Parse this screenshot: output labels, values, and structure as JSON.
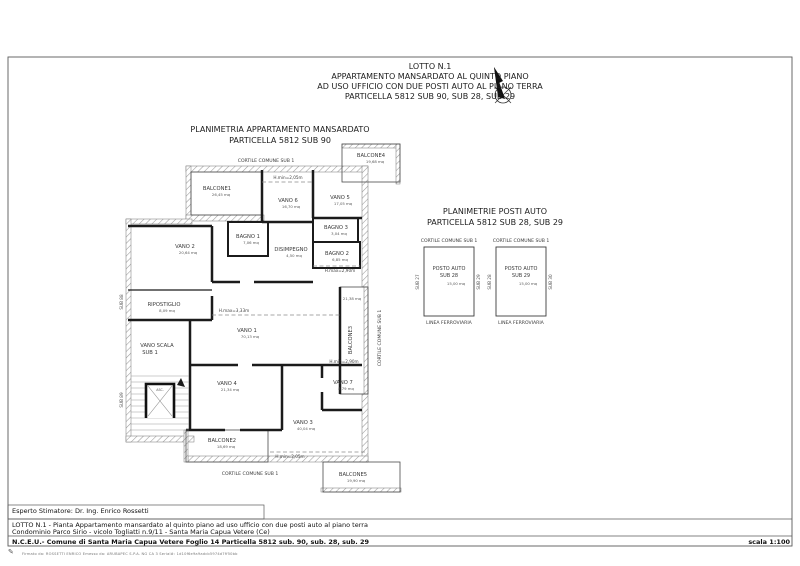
{
  "header": {
    "line1": "LOTTO N.1",
    "line2": "APPARTAMENTO MANSARDATO AL QUINTO PIANO",
    "line3": "AD USO UFFICIO CON DUE POSTI AUTO AL PIANO TERRA",
    "line4": "PARTICELLA 5812 SUB 90, SUB 28, SUB 29"
  },
  "plan_title": {
    "line1": "PLANIMETRIA APPARTAMENTO MANSARDATO",
    "line2": "PARTICELLA 5812 SUB 90"
  },
  "parking_title": {
    "line1": "PLANIMETRIE POSTI AUTO",
    "line2": "PARTICELLA 5812 SUB 28, SUB 29"
  },
  "plan": {
    "cortile_top": "CORTILE COMUNE SUB 1",
    "cortile_bottom": "CORTILE COMUNE SUB 1",
    "cortile_right": "CORTILE COMUNE SUB 1",
    "sub88": "SUB 88",
    "sub89": "SUB 89",
    "stair_label1": "VANO SCALA",
    "stair_label2": "SUB 1",
    "elevator": "ASC.",
    "rooms": {
      "vano1": {
        "name": "VANO 1",
        "area": "70,13 mq"
      },
      "vano2": {
        "name": "VANO 2",
        "area": "20,64 mq"
      },
      "vano3": {
        "name": "VANO 3",
        "area": "40,04 mq"
      },
      "vano4": {
        "name": "VANO 4",
        "area": "21,34 mq"
      },
      "vano5": {
        "name": "VANO 5",
        "area": "17,05 mq"
      },
      "vano6": {
        "name": "VANO 6",
        "area": "16,70 mq"
      },
      "vano7": {
        "name": "VANO 7",
        "area": "8,79 mq"
      },
      "bagno1": {
        "name": "BAGNO 1",
        "area": "7,06 mq"
      },
      "bagno2": {
        "name": "BAGNO 2",
        "area": "6,85 mq"
      },
      "bagno3": {
        "name": "BAGNO 3",
        "area": "3,04 mq"
      },
      "disimpegno": {
        "name": "DISIMPEGNO",
        "area": "4,50 mq"
      },
      "ripostiglio": {
        "name": "RIPOSTIGLIO",
        "area": "8,09 mq"
      },
      "balcone1": {
        "name": "BALCONE1",
        "area": "26,45 mq"
      },
      "balcone2": {
        "name": "BALCONE2",
        "area": "18,69 mq"
      },
      "balcone3": {
        "name": "BALCONE3",
        "area": "21,38 mq"
      },
      "balcone4": {
        "name": "BALCONE4",
        "area": "19,68 mq"
      },
      "balcone5": {
        "name": "BALCONE5",
        "area": "19,90 mq"
      }
    },
    "heights": {
      "top": "H.min=2,05m",
      "center": "H.max=3,33m",
      "mid_right": "H.max=2,90m",
      "bottom_right": "H.min=2,90m",
      "bottom_center": "H.min=2,05m"
    }
  },
  "parking": {
    "spots": [
      {
        "cortile": "CORTILE COMUNE SUB 1",
        "line1": "POSTO AUTO",
        "line2": "SUB 28",
        "area": "15,00 mq",
        "left": "SUB 27",
        "right": "SUB 29",
        "below": "LINEA FERROVIARIA"
      },
      {
        "cortile": "CORTILE COMUNE SUB 1",
        "line1": "POSTO AUTO",
        "line2": "SUB 29",
        "area": "15,00 mq",
        "left": "SUB 28",
        "right": "SUB 30",
        "below": "LINEA FERROVIARIA"
      }
    ]
  },
  "footer": {
    "expert": "Esperto Stimatore: Dr. Ing. Enrico Rossetti",
    "row1": "LOTTO N.1 - Pianta Appartamento mansardato al quinto piano ad uso ufficio con due posti auto al piano terra",
    "row2": "Condominio Parco Sirio - vicolo Togliatti n.9/11 - Santa Maria Capua Vetere (Ce)",
    "row3": "N.C.E.U.- Comune di Santa Maria Capua Vetere Foglio 14 Particella 5812 sub. 90, sub. 28, sub. 29",
    "scale": "scala 1:100",
    "signature": "Firmato da: ROSSETTI ENRICO Emesso da: ARUBAPEC S.P.A. NG CA 3 Serial#: 1d10f6e9a9adcb5974d7ff50bb"
  }
}
